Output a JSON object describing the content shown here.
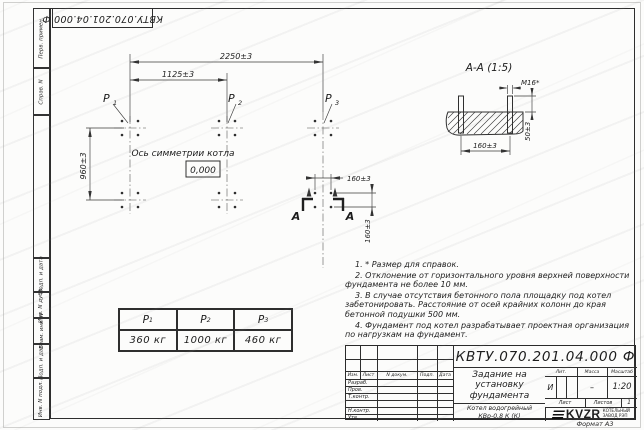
{
  "page": {
    "format_label": "Формат А3"
  },
  "margins": {
    "doc_number_top_rotated": "КВТУ.070.201.04.000 Ф",
    "strip_cells": [
      "Перв. примен.",
      "Справ. N",
      "",
      "Подп. и дата",
      "Инв. N дубл.",
      "Взам. инв. N",
      "Подп. и дата",
      "Инв. N подл."
    ]
  },
  "plan": {
    "dims": {
      "overall": "2250±3",
      "half": "1125±3",
      "depth": "960±3",
      "bolt_span_x": "160±3",
      "bolt_span_y": "160±3"
    },
    "axis_label": "Ось симметрии котла",
    "level_mark": "0,000",
    "loads": [
      {
        "name": "Р",
        "sub": "1"
      },
      {
        "name": "Р",
        "sub": "2"
      },
      {
        "name": "Р",
        "sub": "3"
      }
    ],
    "section_letter_left": "А",
    "section_letter_right": "А"
  },
  "section_view": {
    "title": "А-А (1:5)",
    "bolt_thread": "М16*",
    "dim_height": "50±3",
    "dim_span": "160±3"
  },
  "notes": [
    "1. * Размер для справок.",
    "2. Отклонение от горизонтального уровня верхней поверхности фундамента не более 10 мм.",
    "3. В случае отсутствия бетонного пола площадку под котел забетонировать. Расстояние от осей крайних колонн до края бетонной подушки 500 мм.",
    "4. Фундамент под котел разрабатывает проектная организация по нагрузкам на фундамент."
  ],
  "load_table": {
    "headers": [
      {
        "name": "Р",
        "sub": "1"
      },
      {
        "name": "Р",
        "sub": "2"
      },
      {
        "name": "Р",
        "sub": "3"
      }
    ],
    "values": [
      "360 кг",
      "1000 кг",
      "460 кг"
    ]
  },
  "title_block": {
    "doc_number": "КВТУ.070.201.04.000 Ф",
    "doc_title": [
      "Задание на",
      "установку",
      "фундамента"
    ],
    "product": [
      "Котел водогрейный",
      "КВр-0,8 К (К)"
    ],
    "rev_cols": [
      "Изм.",
      "Лист",
      "N докум.",
      "Подп.",
      "Дата"
    ],
    "roles": [
      "Разраб.",
      "Пров.",
      "Т.контр.",
      "",
      "Н.контр.",
      "Утв."
    ],
    "lit_label": "Лит.",
    "mass_label": "Масса",
    "scale_label": "Масштаб",
    "lit_value": "И",
    "mass_value": "–",
    "scale_value": "1:20",
    "sheet_label": "Лист",
    "sheets_label": "Листов",
    "sheets_value": "1",
    "logo": {
      "brand": "KVZR",
      "caption": [
        "КОТЕЛЬНЫЙ",
        "ЗАВОД РЭП"
      ]
    }
  },
  "colors": {
    "line": "#2e2e2e",
    "paper": "#fcfcfb",
    "watermark": "#bdbdbd"
  }
}
